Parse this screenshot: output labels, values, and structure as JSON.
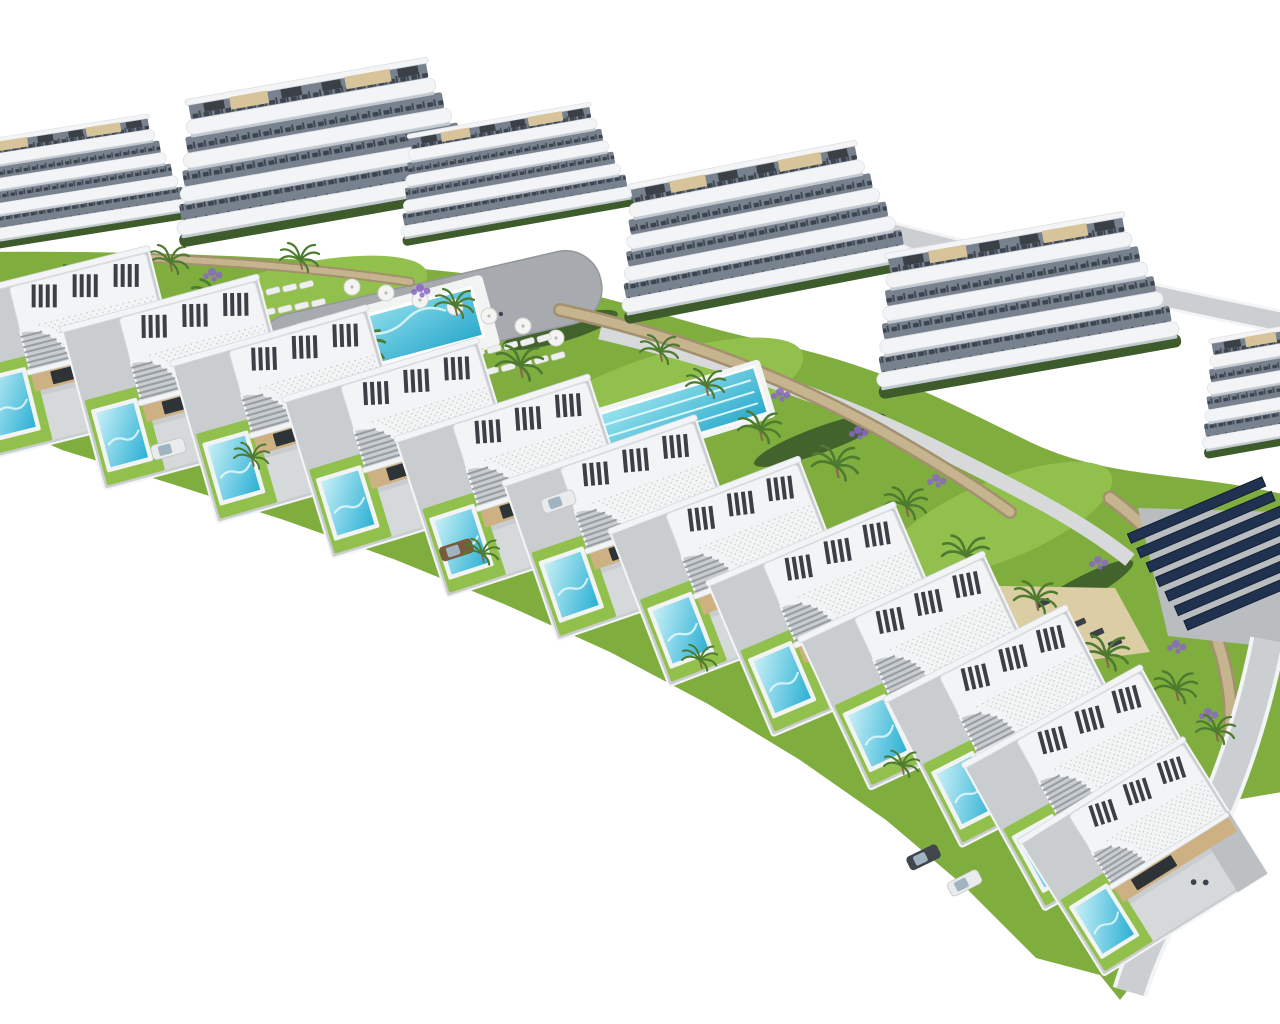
{
  "scene": {
    "description": "Aerial 3D architectural render of a hillside residential development on a white background: six white apartment blocks with wavy curved balconies and rooftop terraces at the back, a landscaped amenity band with a large community pool with parasols and sun loungers, a lap pool, a grey playground plaza, palm trees, lavender beds and tan stone retaining walls, and a long stepped arc of twelve modern detached villas in front, each with a white roof terrace with dark louvre slats, a curved stair cut-out, beige walls, a small turquoise private pool, lawn and driveway; a dark solar-panel array and a curving road sit at the lower right",
    "style": "photorealistic CGI, isometric-like aerial view",
    "background": "white",
    "inventory": {
      "apartment_blocks": 6,
      "apartment_floors_per_block": 4,
      "villas": 12,
      "private_pools": 12,
      "community_pools": 1,
      "lap_pools": 1,
      "playgrounds": 1,
      "solar_panel_rows": 7,
      "parasols": 7,
      "cars": 5
    }
  },
  "palette": {
    "bg": "#ffffff",
    "building_white": "#f3f4f5",
    "building_edge": "#d9dde1",
    "band_shadow": "#c3c9d0",
    "furn_bg": "#78828e",
    "furn_dark": "#3c4450",
    "hedge": "#3d5b2b",
    "lawn": "#7fad3e",
    "lawn_light": "#92c04d",
    "terrace": "#c9cdcf",
    "driveway": "#bcc0c3",
    "patio": "#d6d9da",
    "beige": "#ceb183",
    "glass": "#2e3338",
    "slat": "#3b4047",
    "roof_beige": "#d8c49a",
    "stair": "#989ea3",
    "pool_rim": "#f2f4f4",
    "pool_deep": "#2bb0d4",
    "pool_pale": "#c8f0f7",
    "lap_deep": "#2aa9cc",
    "lap_pale": "#9de5f0",
    "pool_sparkle": "#e9fbfd",
    "sand": "#dbcda4",
    "asphalt": "#a7abaf",
    "path": "#d7d9da",
    "road": "#cbcfd2",
    "stone_dark": "#a3906f",
    "stone_light": "#c6b48e",
    "trunk": "#8a6a48",
    "palm": "#4d7b30",
    "lavender": "#8a67c6",
    "solar": "#20324f",
    "solar_edge": "#141f33",
    "pad": "#b9bdc0"
  }
}
